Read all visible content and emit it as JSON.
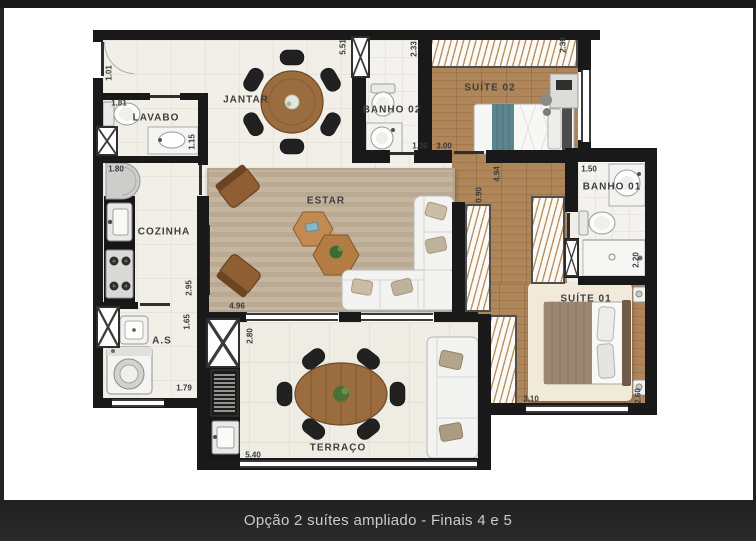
{
  "caption": "Opção 2 suítes ampliado - Finais 4 e 5",
  "rooms": {
    "jantar": "JANTAR",
    "lavabo": "LAVABO",
    "cozinha": "COZINHA",
    "as": "A.S",
    "estar": "ESTAR",
    "terraco": "TERRAÇO",
    "banho02": "BANHO 02",
    "suite02": "SUÍTE 02",
    "banho01": "BANHO 01",
    "suite01": "SUÍTE 01"
  },
  "dims": {
    "entry_h": "1.01",
    "lavabo_w": "1.81",
    "lavabo_h": "1.15",
    "cozinha_w": "1.80",
    "cozinha_h": "2.95",
    "as_h": "1.65",
    "as_w": "1.79",
    "estar_w": "4.96",
    "terraco_h": "2.80",
    "terraco_w": "5.40",
    "banho02_h": "5.51",
    "banho02_w": "1.30",
    "suite02_left": "2.33",
    "suite02_right": "2.39",
    "suite02_w": "3.00",
    "hall_h": "4.94",
    "hall_w": "0.90",
    "banho01_w": "1.50",
    "banho01_h": "2.20",
    "suite01_w": "3.10",
    "suite01_h": "2.60"
  },
  "colors": {
    "wall": "#191919",
    "wood_floor": "#aa7e50",
    "estar_rug": "#c2b199",
    "terraco_floor": "#efece4",
    "caption_bg": "#242424",
    "caption_text": "#cbcbcb"
  }
}
